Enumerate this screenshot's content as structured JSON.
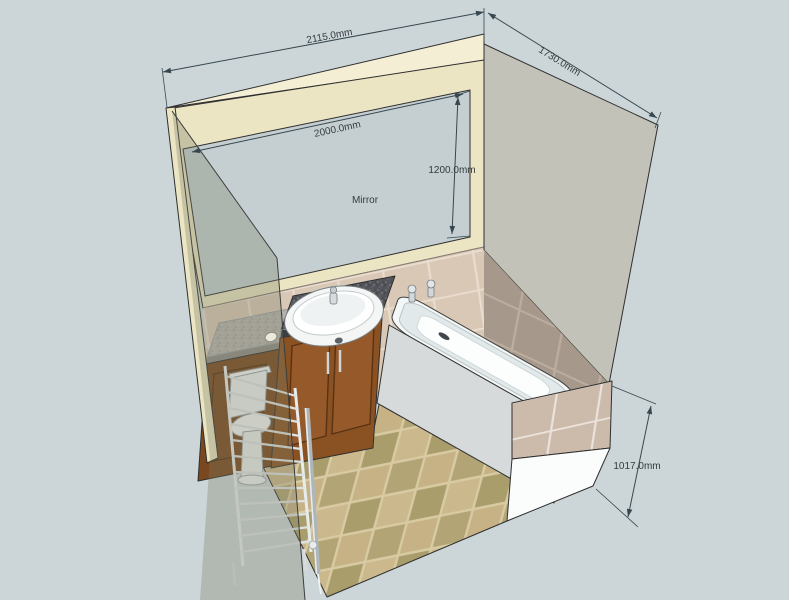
{
  "scene": {
    "type": "3d-room-design-view",
    "room": "bathroom",
    "annotations": {
      "mirror_label": "Mirror"
    },
    "dimensions": [
      {
        "id": "back-wall-width",
        "value": "2115.0mm"
      },
      {
        "id": "right-wall-depth",
        "value": "1730.0mm"
      },
      {
        "id": "mirror-width",
        "value": "2000.0mm"
      },
      {
        "id": "mirror-height",
        "value": "1200.0mm"
      },
      {
        "id": "front-wall-height",
        "value": "1017.0mm"
      }
    ],
    "colors": {
      "background": "#ccd6d9",
      "wall_cream": "#ebe5c3",
      "wall_top_cream": "#f3eed4",
      "mirror": "#c5cfd2",
      "right_wall_gray": "#c2c2b9",
      "right_wall_tile": "#a6988a",
      "wainscot_tile": "#dac8b6",
      "half_wall_tile": "#ccbaab",
      "floor_tile_light": "#cbb88d",
      "floor_tile_dark": "#a99d6c",
      "floor_grout": "#d8cba3",
      "granite_dark": "#53545a",
      "granite_light": "#b6b2ad",
      "wood": "#8a5223",
      "fixture_white": "#f4f7f7",
      "dimension_ink": "#37474f"
    }
  }
}
